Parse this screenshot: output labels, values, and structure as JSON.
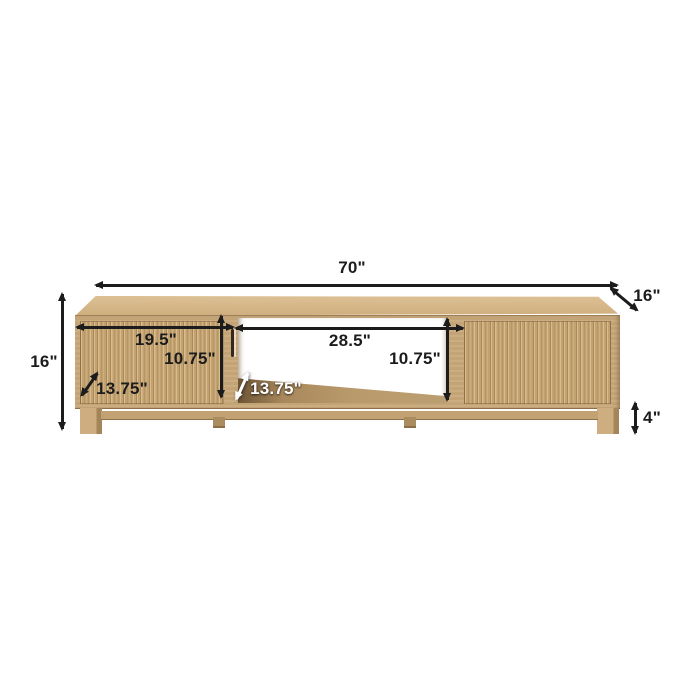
{
  "annotations": {
    "overall_width": "70\"",
    "overall_depth": "16\"",
    "overall_height": "16\"",
    "left_cabinet_width": "19.5\"",
    "left_cabinet_interior_height": "10.75\"",
    "left_cabinet_depth": "13.75\"",
    "center_shelf_width": "28.5\"",
    "center_shelf_interior_height": "10.75\"",
    "center_shelf_depth": "13.75\"",
    "leg_height": "4\""
  },
  "colors": {
    "page_bg": "#ffffff",
    "annotation_ink": "#1c1c1c",
    "annotation_light": "#ffffff",
    "wood_top": "#d4b586",
    "wood_front": "#c9a97b",
    "wood_flute_dark": "#a9885a",
    "wood_flute_light": "#d9bb8c",
    "wood_shelf": "#b2946a",
    "wood_base": "#c2a272",
    "handle_groove": "#33281a",
    "opening_background": "#ffffff"
  }
}
